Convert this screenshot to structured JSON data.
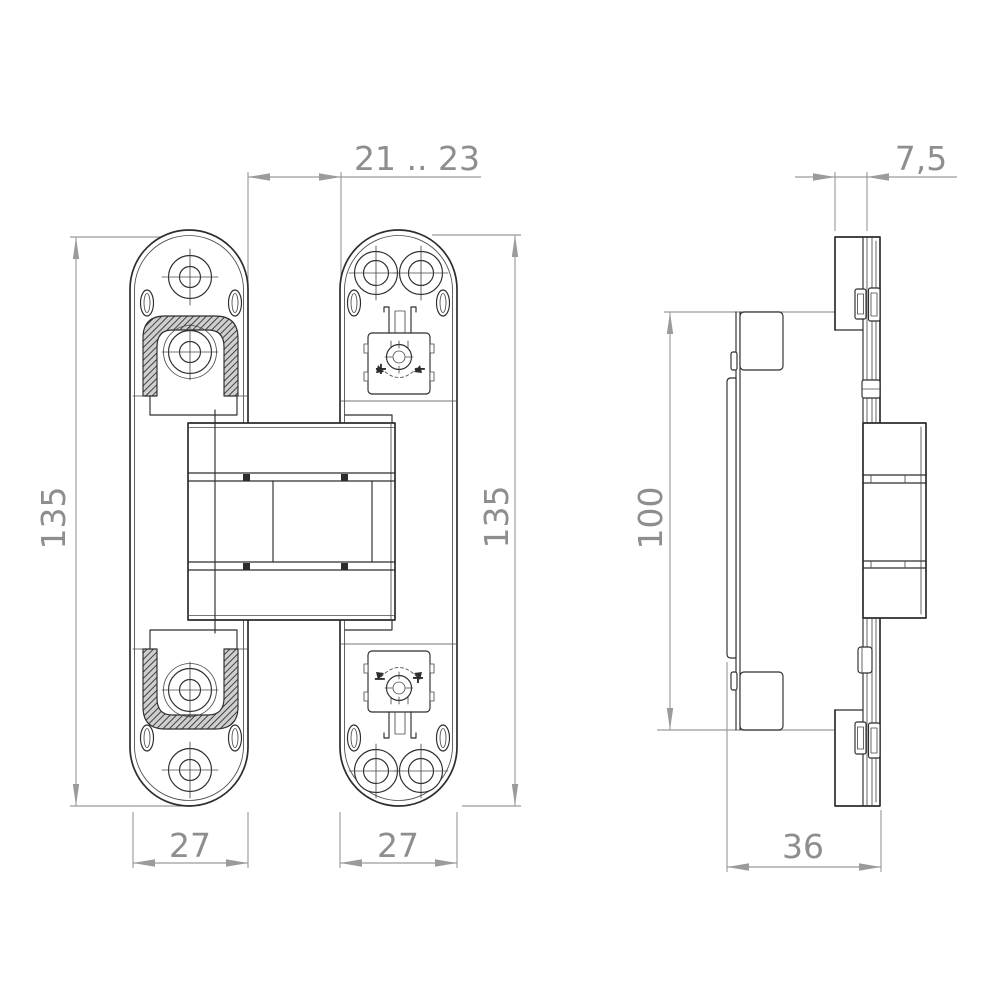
{
  "colors": {
    "line": "#2d2d2d",
    "line-soft": "#4a4a4a",
    "dim": "#9b9b9b",
    "dim-text": "#8e8e8e",
    "bg": "#ffffff"
  },
  "dimensions": {
    "door_gap": "21 .. 23",
    "frame_plate_thickness": "7,5",
    "left_plate_height": "135",
    "right_plate_height": "135",
    "side_body_height": "100",
    "left_plate_width": "27",
    "right_plate_width": "27",
    "side_depth": "36"
  },
  "adjuster_labels": {
    "top_left": "+",
    "top_right": "−",
    "bottom_left": "−",
    "bottom_right": "+"
  }
}
